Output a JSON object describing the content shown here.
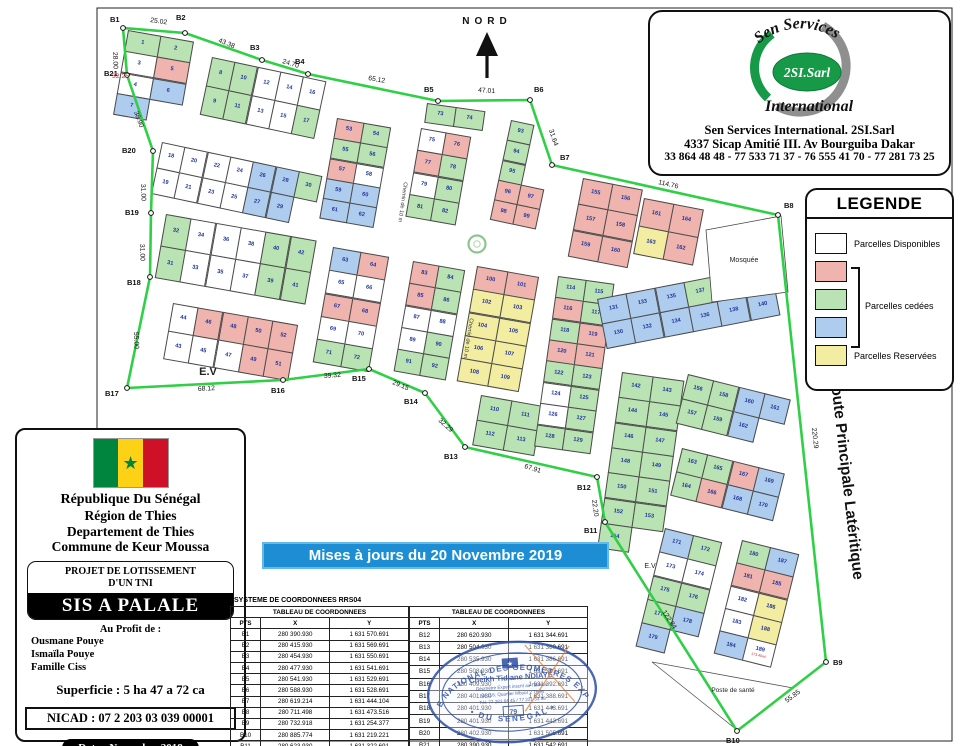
{
  "map": {
    "north_label": "NORD",
    "boundary_color": "#2fd045",
    "colors": {
      "w": "#ffffff",
      "p": "#efb4ae",
      "g": "#b9e3b2",
      "b": "#aecdee",
      "y": "#f2eda0"
    },
    "points": [
      {
        "id": "B1",
        "x": 123,
        "y": 28,
        "lx": 110,
        "ly": 22
      },
      {
        "id": "B2",
        "x": 185,
        "y": 33,
        "lx": 176,
        "ly": 20
      },
      {
        "id": "B3",
        "x": 262,
        "y": 60,
        "lx": 250,
        "ly": 50
      },
      {
        "id": "B4",
        "x": 308,
        "y": 74,
        "lx": 295,
        "ly": 64
      },
      {
        "id": "B5",
        "x": 438,
        "y": 101,
        "lx": 424,
        "ly": 92
      },
      {
        "id": "B6",
        "x": 530,
        "y": 100,
        "lx": 534,
        "ly": 92
      },
      {
        "id": "B7",
        "x": 552,
        "y": 165,
        "lx": 560,
        "ly": 160
      },
      {
        "id": "B8",
        "x": 778,
        "y": 215,
        "lx": 784,
        "ly": 208
      },
      {
        "id": "B9",
        "x": 826,
        "y": 662,
        "lx": 833,
        "ly": 665
      },
      {
        "id": "B10",
        "x": 737,
        "y": 731,
        "lx": 726,
        "ly": 743
      },
      {
        "id": "B11",
        "x": 605,
        "y": 522,
        "lx": 584,
        "ly": 533
      },
      {
        "id": "B12",
        "x": 597,
        "y": 477,
        "lx": 577,
        "ly": 490
      },
      {
        "id": "B13",
        "x": 465,
        "y": 447,
        "lx": 444,
        "ly": 459
      },
      {
        "id": "B14",
        "x": 425,
        "y": 393,
        "lx": 404,
        "ly": 404
      },
      {
        "id": "B15",
        "x": 369,
        "y": 369,
        "lx": 352,
        "ly": 381
      },
      {
        "id": "B16",
        "x": 283,
        "y": 380,
        "lx": 271,
        "ly": 393
      },
      {
        "id": "B17",
        "x": 127,
        "y": 388,
        "lx": 105,
        "ly": 396
      },
      {
        "id": "B18",
        "x": 150,
        "y": 277,
        "lx": 127,
        "ly": 285
      },
      {
        "id": "B19",
        "x": 151,
        "y": 213,
        "lx": 125,
        "ly": 215
      },
      {
        "id": "B20",
        "x": 153,
        "y": 151,
        "lx": 122,
        "ly": 153
      },
      {
        "id": "B21",
        "x": 127,
        "y": 75,
        "lx": 104,
        "ly": 76
      }
    ],
    "edge_labels": [
      {
        "t": "25.02",
        "x": 150,
        "y": 22,
        "r": 8
      },
      {
        "t": "43.38",
        "x": 218,
        "y": 42,
        "r": 22
      },
      {
        "t": "24.70",
        "x": 282,
        "y": 63,
        "r": 17
      },
      {
        "t": "65.12",
        "x": 368,
        "y": 80,
        "r": 10
      },
      {
        "t": "47.01",
        "x": 478,
        "y": 92,
        "r": 4
      },
      {
        "t": "31.64",
        "x": 549,
        "y": 130,
        "r": 72
      },
      {
        "t": "114.76",
        "x": 658,
        "y": 184,
        "r": 13
      },
      {
        "t": "220.29",
        "x": 812,
        "y": 428,
        "r": 84
      },
      {
        "t": "55.85",
        "x": 787,
        "y": 703,
        "r": -37
      },
      {
        "t": "122.84",
        "x": 662,
        "y": 612,
        "r": 57
      },
      {
        "t": "22.20",
        "x": 592,
        "y": 500,
        "r": 82
      },
      {
        "t": "67.91",
        "x": 524,
        "y": 468,
        "r": 17
      },
      {
        "t": "32.29",
        "x": 438,
        "y": 421,
        "r": 42
      },
      {
        "t": "29.15",
        "x": 392,
        "y": 384,
        "r": 22
      },
      {
        "t": "39.32",
        "x": 324,
        "y": 378,
        "r": -4
      },
      {
        "t": "68.12",
        "x": 198,
        "y": 391,
        "r": -3
      },
      {
        "t": "55.00",
        "x": 134,
        "y": 332,
        "r": 88
      },
      {
        "t": "31.00",
        "x": 140,
        "y": 244,
        "r": 88
      },
      {
        "t": "31.00",
        "x": 141,
        "y": 184,
        "r": 88
      },
      {
        "t": "38.90",
        "x": 134,
        "y": 112,
        "r": 70
      },
      {
        "t": "28.00",
        "x": 113,
        "y": 52,
        "r": 88
      },
      {
        "t": "32.25",
        "x": 112,
        "y": 78,
        "r": 0,
        "red": true
      }
    ],
    "street_labels": [
      {
        "t": "Chemin de 10 m",
        "x": 404,
        "y": 182,
        "r": 98
      },
      {
        "t": "Chemin de 10 m",
        "x": 470,
        "y": 318,
        "r": 99
      }
    ],
    "route_label": "Route Principale Latéritique",
    "area_labels": [
      {
        "t": "E.V",
        "x": 208,
        "y": 375,
        "s": 11
      },
      {
        "t": "E.V",
        "x": 650,
        "y": 568,
        "s": 7
      },
      {
        "t": "Mosquée",
        "x": 744,
        "y": 262,
        "s": 7
      },
      {
        "t": "Poste de santé",
        "x": 733,
        "y": 692,
        "s": 6.5
      }
    ],
    "blocks": [
      {
        "x": 128,
        "y": 30,
        "rot": 10,
        "cw": 34,
        "ch": 22,
        "rows": [
          [
            "1g",
            "2g"
          ],
          [
            "3w",
            "5p"
          ],
          [
            "4w",
            "6b"
          ],
          [
            "7b"
          ]
        ]
      },
      {
        "x": 212,
        "y": 57,
        "rot": 12,
        "cw": 24,
        "ch": 30,
        "rows": [
          [
            "8g",
            "10g",
            "12w",
            "14w",
            "16w"
          ],
          [
            "9g",
            "11g",
            "13w",
            "15w",
            "17g"
          ]
        ]
      },
      {
        "x": 162,
        "y": 142,
        "rot": 12,
        "cw": 24,
        "ch": 27,
        "rows": [
          [
            "18w",
            "20w",
            "22w",
            "24w",
            "26b",
            "28b",
            "30g"
          ],
          [
            "19w",
            "21w",
            "23w",
            "25w",
            "27b",
            "29b"
          ]
        ]
      },
      {
        "x": 166,
        "y": 214,
        "rot": 10,
        "cw": 26,
        "ch": 33,
        "rows": [
          [
            "32g",
            "34w",
            "36w",
            "38w",
            "40g",
            "42g"
          ],
          [
            "31g",
            "33w",
            "35w",
            "37w",
            "39g",
            "41g"
          ]
        ]
      },
      {
        "x": 173,
        "y": 303,
        "rot": 10,
        "cw": 26,
        "ch": 29,
        "rows": [
          [
            "44w",
            "46p",
            "48p",
            "50p",
            "52p"
          ],
          [
            "43w",
            "45w",
            "47w",
            "49p",
            "51p"
          ]
        ]
      },
      {
        "x": 337,
        "y": 118,
        "rot": 10,
        "cw": 28,
        "ch": 21,
        "rows": [
          [
            "53p",
            "54g"
          ],
          [
            "55g",
            "56g"
          ],
          [
            "57p",
            "58w"
          ],
          [
            "59b",
            "60b"
          ],
          [
            "61b",
            "62b"
          ]
        ]
      },
      {
        "x": 333,
        "y": 247,
        "rot": 10,
        "cw": 29,
        "ch": 24,
        "rows": [
          [
            "63b",
            "64p"
          ],
          [
            "65w",
            "66w"
          ],
          [
            "67p",
            "68p"
          ],
          [
            "69w",
            "70w"
          ],
          [
            "71g",
            "72g"
          ]
        ]
      },
      {
        "x": 427,
        "y": 103,
        "rot": 8,
        "cw": 30,
        "ch": 20,
        "rows": [
          [
            "73g",
            "74g"
          ]
        ]
      },
      {
        "x": 421,
        "y": 128,
        "rot": 10,
        "cw": 26,
        "ch": 23,
        "rows": [
          [
            "75w",
            "76p"
          ],
          [
            "77p",
            "78g"
          ],
          [
            "79w",
            "80g"
          ],
          [
            "81g",
            "82g"
          ]
        ]
      },
      {
        "x": 413,
        "y": 261,
        "rot": 10,
        "cw": 27,
        "ch": 23,
        "rows": [
          [
            "83p",
            "84g"
          ],
          [
            "85p",
            "86g"
          ],
          [
            "87w",
            "88w"
          ],
          [
            "89w",
            "90g"
          ],
          [
            "91g",
            "92g"
          ]
        ]
      },
      {
        "x": 511,
        "y": 120,
        "rot": 12,
        "cw": 24,
        "ch": 21,
        "rows": [
          [
            "93g"
          ],
          [
            "94g"
          ],
          [
            "95g"
          ],
          [
            "96p",
            "97p"
          ],
          [
            "98p",
            "99p"
          ]
        ]
      },
      {
        "x": 477,
        "y": 266,
        "rot": 10,
        "cw": 32,
        "ch": 24,
        "rows": [
          [
            "100p",
            "101p"
          ],
          [
            "102y",
            "103y"
          ],
          [
            "104y",
            "105y"
          ],
          [
            "106y",
            "107y"
          ],
          [
            "108y",
            "109y"
          ]
        ]
      },
      {
        "x": 481,
        "y": 395,
        "rot": 10,
        "cw": 32,
        "ch": 26,
        "rows": [
          [
            "110g",
            "111g"
          ],
          [
            "112g",
            "113g"
          ]
        ]
      },
      {
        "x": 558,
        "y": 276,
        "rot": 8,
        "cw": 29,
        "ch": 22,
        "rows": [
          [
            "114g",
            "115g"
          ],
          [
            "116p",
            "117g"
          ],
          [
            "118g",
            "119p"
          ],
          [
            "120p",
            "121p"
          ],
          [
            "122g",
            "123g"
          ],
          [
            "124w",
            "125g"
          ],
          [
            "126w",
            "127g"
          ],
          [
            "128g",
            "129g"
          ]
        ]
      },
      {
        "x": 597,
        "y": 299,
        "rot": -11,
        "cw": 30,
        "ch": 26,
        "rows": [
          [
            "131b",
            "133b",
            "135b",
            "137g",
            "139b",
            "141p|264.19m²"
          ],
          [
            "130b",
            "132b",
            "134b",
            "136b",
            "138b",
            "140b"
          ]
        ]
      },
      {
        "x": 622,
        "y": 372,
        "rot": 8,
        "cw": 32,
        "ch": 26,
        "rows": [
          [
            "142g",
            "143g"
          ],
          [
            "144g",
            "145g"
          ],
          [
            "146g",
            "147g"
          ],
          [
            "148g",
            "149g"
          ],
          [
            "150g",
            "151g"
          ],
          [
            "152g",
            "153g"
          ],
          [
            "154g"
          ]
        ]
      },
      {
        "x": 583,
        "y": 178,
        "rot": 11,
        "cw": 31,
        "ch": 27,
        "rows": [
          [
            "155p",
            "156p"
          ],
          [
            "157p",
            "158p"
          ],
          [
            "159p",
            "160p"
          ]
        ]
      },
      {
        "x": 644,
        "y": 198,
        "rot": 11,
        "cw": 31,
        "ch": 29,
        "rows": [
          [
            "161p",
            "164p"
          ],
          [
            "163y",
            "162p"
          ]
        ]
      },
      {
        "x": 688,
        "y": 374,
        "rot": 14,
        "cw": 27,
        "ch": 26,
        "rows": [
          [
            "156g",
            "158g",
            "160b",
            "161b"
          ],
          [
            "157g",
            "159g",
            "162b"
          ]
        ]
      },
      {
        "x": 682,
        "y": 448,
        "rot": 14,
        "cw": 27,
        "ch": 25,
        "rows": [
          [
            "163g",
            "165g",
            "167p",
            "169b"
          ],
          [
            "164g",
            "166p",
            "168b",
            "170b"
          ]
        ]
      },
      {
        "x": 665,
        "y": 528,
        "rot": 14,
        "cw": 30,
        "ch": 25,
        "rows": [
          [
            "171b",
            "172g"
          ],
          [
            "173w",
            "174w"
          ],
          [
            "175g",
            "176g"
          ],
          [
            "177g",
            "178b"
          ],
          [
            "179b"
          ]
        ]
      },
      {
        "x": 742,
        "y": 540,
        "rot": 14,
        "cw": 30,
        "ch": 24,
        "rows": [
          [
            "180g",
            "187b"
          ],
          [
            "181p",
            "185p"
          ],
          [
            "182w",
            "186y"
          ],
          [
            "183w",
            "188y"
          ],
          [
            "184b",
            "189w|173.45m²"
          ]
        ]
      }
    ]
  },
  "logo_box": {
    "brand_arc": "Sen Services",
    "brand_oval": "2SI.Sarl",
    "brand_under": "International",
    "name": "Sen Services International. 2SI.Sarl",
    "address": "4337 Sicap Amitié III. Av Bourguiba Dakar",
    "phones": "33 864 48 48 - 77 533 71 37 - 76 555 41 70 - 77 281 73 25",
    "green": "#169a47",
    "gray": "#8f8f8f"
  },
  "legend": {
    "title": "LEGENDE",
    "item_disponibles": "Parcelles Disponibles",
    "item_cedees": "Parcelles cedées",
    "item_reservees": "Parcelles Reservées"
  },
  "info_box": {
    "line1": "République Du Sénégal",
    "line2": "Région de Thies",
    "line3": "Departement de Thies",
    "line4": "Commune de Keur Moussa",
    "project_title1": "PROJET DE LOTISSEMENT",
    "project_title2": "D'UN TNI",
    "project_name": "SIS A PALALE",
    "profit_label": "Au Profit de :",
    "beneficiaries": [
      "Ousmane Pouye",
      "Ismaïla Pouye",
      "Famille Ciss"
    ],
    "superficie": "Superficie : 5 ha 47 a 72 ca",
    "nicad": "NICAD : 07 2 203 03 039 00001",
    "date": "Date : Novembre 2018"
  },
  "banner": {
    "text": "Mises à jours du 20 Novembre  2019"
  },
  "coords": {
    "system_title": "SYSTEME DE COORDONNEES RRS04",
    "table_title": "TABLEAU DE COORDONNEES",
    "col_headers": [
      "PTS",
      "X",
      "Y"
    ],
    "left_rows": [
      [
        "B1",
        "280 390.930",
        "1 631 570.691"
      ],
      [
        "B2",
        "280 415.930",
        "1 631 569.691"
      ],
      [
        "B3",
        "280 454.930",
        "1 631 550.691"
      ],
      [
        "B4",
        "280 477.930",
        "1 631 541.691"
      ],
      [
        "B5",
        "280 541.930",
        "1 631 529.691"
      ],
      [
        "B6",
        "280 588.930",
        "1 631 528.691"
      ],
      [
        "B7",
        "280 619.214",
        "1 631 444.104"
      ],
      [
        "B8",
        "280 711.498",
        "1 631 473.516"
      ],
      [
        "B9",
        "280 732.918",
        "1 631 254.377"
      ],
      [
        "B10",
        "280 885.774",
        "1 631 219.221"
      ],
      [
        "B11",
        "280 623.930",
        "1 631 322.691"
      ]
    ],
    "right_rows": [
      [
        "B12",
        "280 620.930",
        "1 631 344.691"
      ],
      [
        "B13",
        "280 504.930",
        "1 631 380.691"
      ],
      [
        "B14",
        "280 535.930",
        "1 631 386.691"
      ],
      [
        "B15",
        "280 508.930",
        "1 631 397.691"
      ],
      [
        "B16",
        "280 409.930",
        "1 631 392.691"
      ],
      [
        "B17",
        "280 401.930",
        "1 631 388.691"
      ],
      [
        "B18",
        "280 401.930",
        "1 631 443.691"
      ],
      [
        "B19",
        "280 401.930",
        "1 631 443.691"
      ],
      [
        "B20",
        "280 402.930",
        "1 631 505.691"
      ],
      [
        "B21",
        "280 390.930",
        "1 631 542.691"
      ]
    ]
  },
  "stamp": {
    "arc_top": "ORDRE NATIONAL DES GEOMETRES EXPERTS",
    "arc_bottom": "•  DU SENEGAL  •",
    "name": "Cheikh Tidiane NDIAYE",
    "line1": "Géomètre Expert inscrit au Tableau",
    "line2": "Lot 116, Quartier Mbour 2 Thiès",
    "line3": "Tél. 77 283 84 45 / 77 221 33 98",
    "number": "79",
    "blue": "#3353a8"
  }
}
